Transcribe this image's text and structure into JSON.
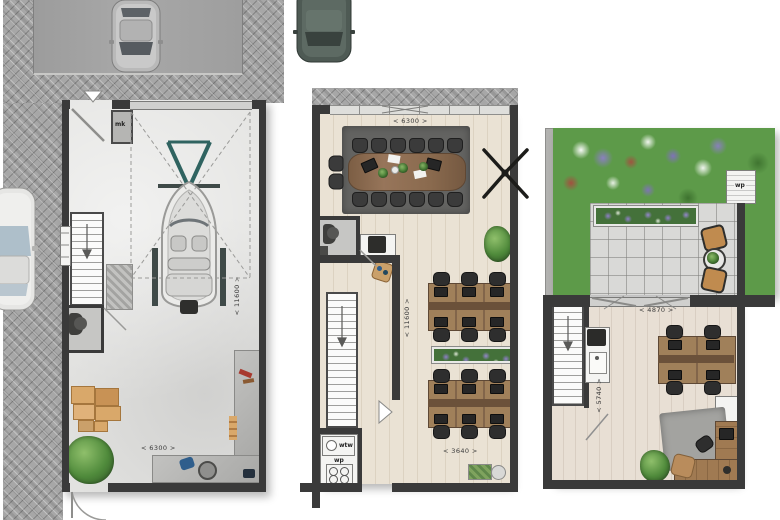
{
  "doc": {
    "title": "Bedrijfsunit plattegronden"
  },
  "garage": {
    "height_dim": "< 11600 >",
    "width_dim": "< 6300 >",
    "meter_cupboard": "mk"
  },
  "floor1": {
    "top_width_dim": "< 6300 >",
    "height_dim": "< 11600 >",
    "bottom_width_dim": "< 3640 >",
    "heat_recovery_unit": "wtw",
    "heat_pump": "wp"
  },
  "floor2": {
    "terrace_width_dim": "< 4870 >",
    "room_height_dim": "< 5740 >",
    "roof_heat_pump": "wp"
  }
}
